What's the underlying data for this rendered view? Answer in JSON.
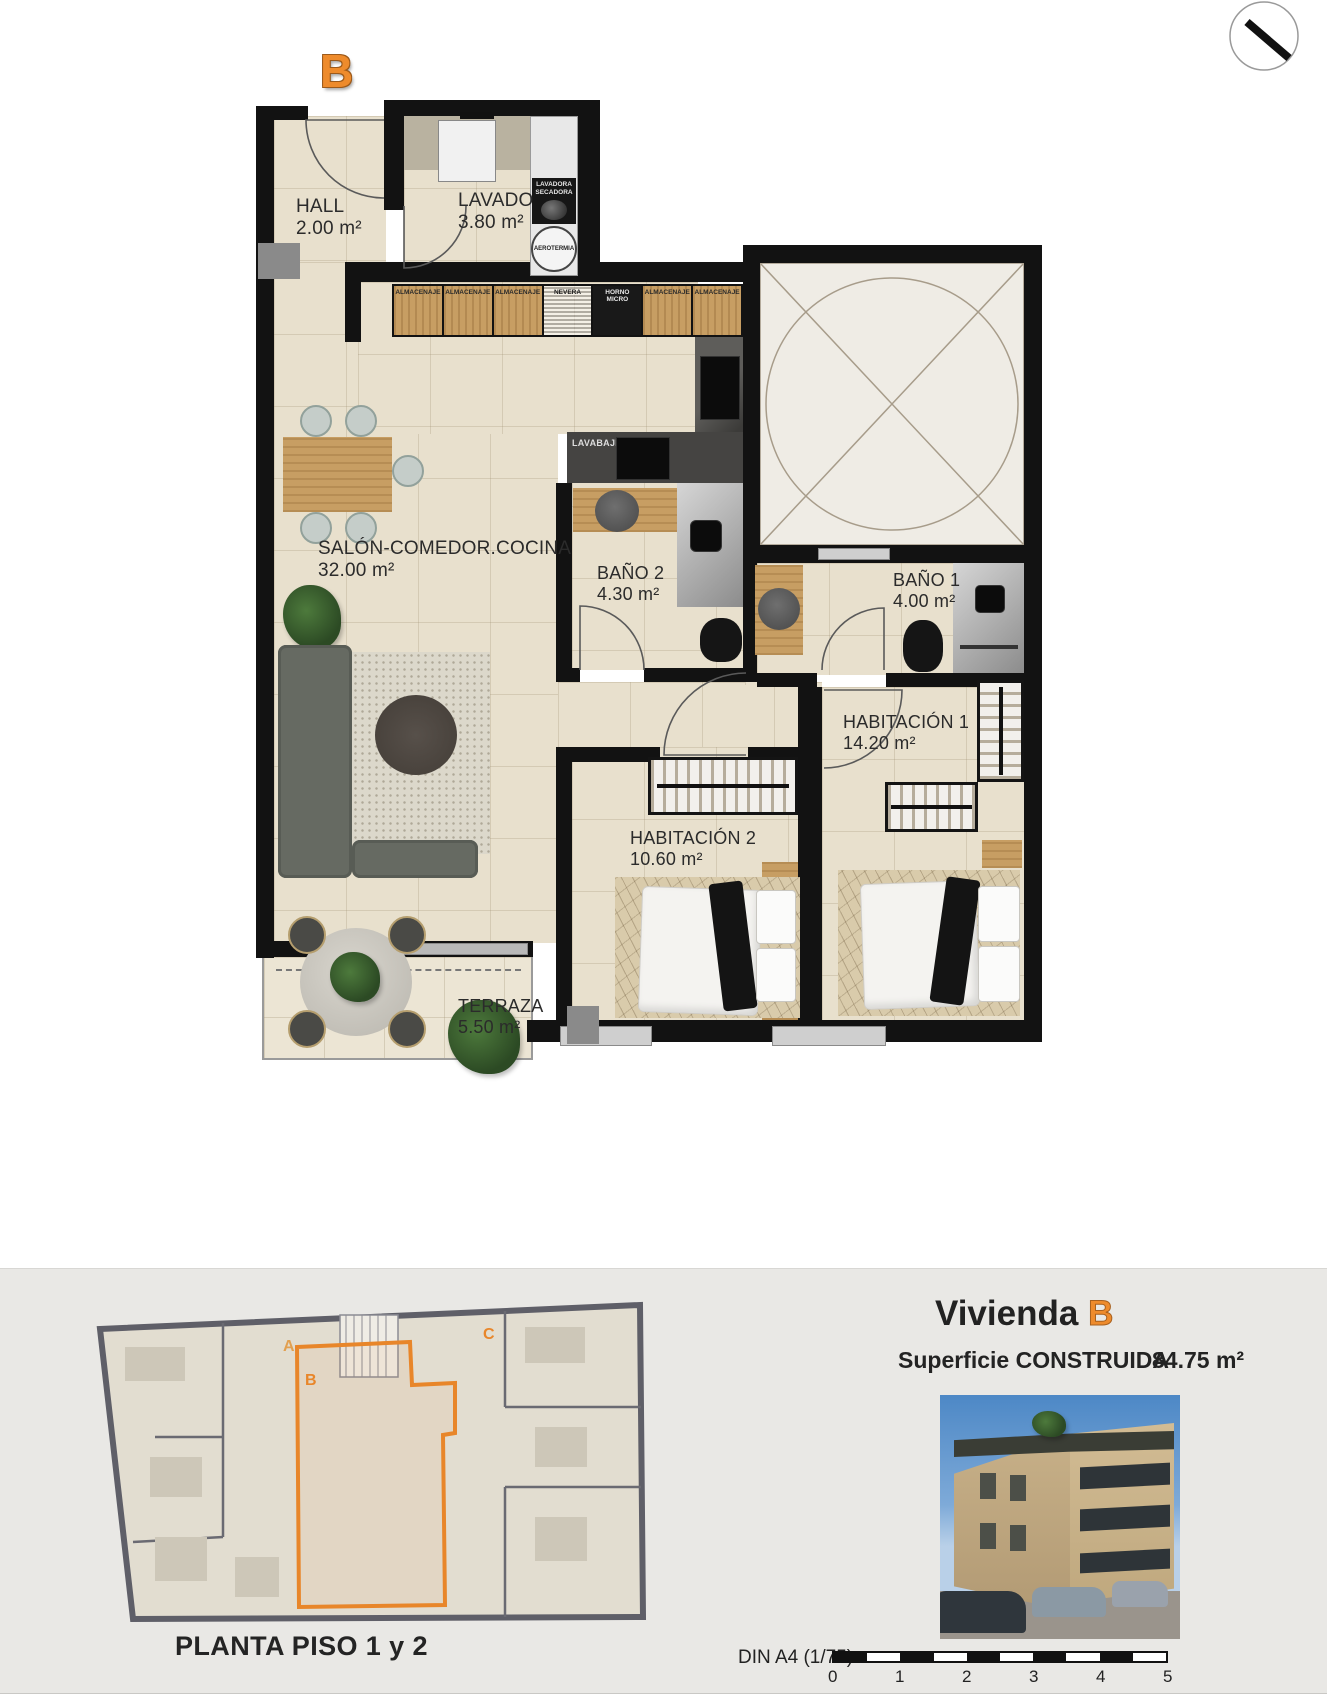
{
  "header": {
    "unit_letter": "B"
  },
  "compass": {
    "name": "north-indicator"
  },
  "plan": {
    "rooms": [
      {
        "name": "HALL",
        "area": "2.00 m²"
      },
      {
        "name": "LAVADO",
        "area": "3.80 m²"
      },
      {
        "name": "SALÓN-COMEDOR.COCINA",
        "area": "32.00 m²"
      },
      {
        "name": "BAÑO 2",
        "area": "4.30 m²"
      },
      {
        "name": "BAÑO 1",
        "area": "4.00 m²"
      },
      {
        "name": "HABITACIÓN 1",
        "area": "14.20 m²"
      },
      {
        "name": "HABITACIÓN 2",
        "area": "10.60 m²"
      },
      {
        "name": "TERRAZA",
        "area": "5.50 m²"
      }
    ],
    "kitchen_units": [
      "ALMACENAJE",
      "ALMACENAJE",
      "ALMACENAJE",
      "NEVERA",
      "HORNO MICRO",
      "ALMACENAJE",
      "ALMACENAJE"
    ],
    "appliances": {
      "washer_line1": "LAVADORA",
      "washer_line2": "SECADORA",
      "aerotermia": "AEROTERMIA",
      "dishwasher": "LAVABAJILLAS"
    }
  },
  "footer": {
    "overview": {
      "letters": [
        "A",
        "B",
        "C"
      ],
      "caption": "PLANTA PISO 1 y 2"
    },
    "title": {
      "text": "Vivienda",
      "letter": "B"
    },
    "surface": {
      "label": "Superficie CONSTRUIDA",
      "value": "84.75 m²"
    },
    "scale": {
      "label": "DIN A4 (1/75)",
      "ticks": [
        "0",
        "1",
        "2",
        "3",
        "4",
        "5"
      ]
    }
  },
  "colors": {
    "accent_orange": "#ee8b2c",
    "wall_black": "#121212",
    "floor_beige": "#e8e0cd",
    "footer_gray": "#e9e8e5"
  }
}
